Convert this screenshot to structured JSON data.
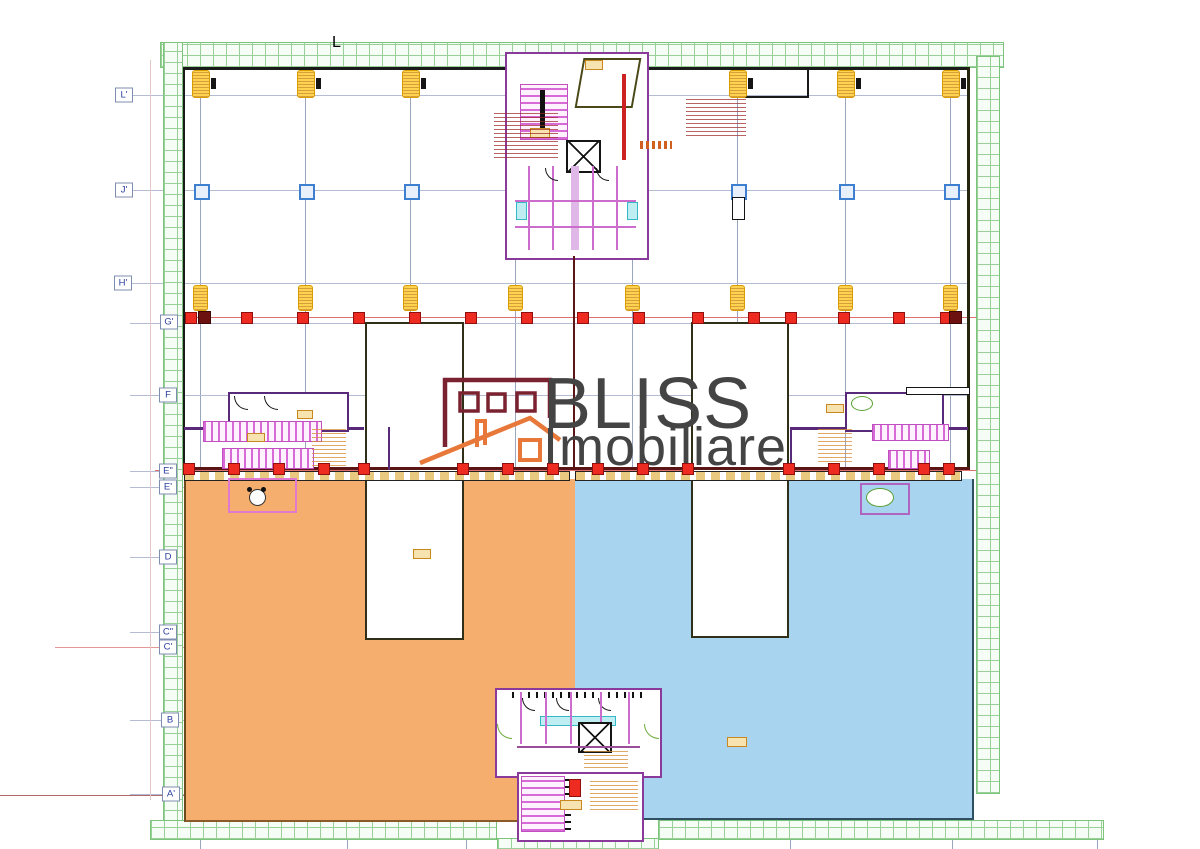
{
  "grid": {
    "top_label": "L",
    "row_labels": [
      {
        "label": "L'",
        "x": 124,
        "y": 95
      },
      {
        "label": "J'",
        "x": 124,
        "y": 190
      },
      {
        "label": "H'",
        "x": 123,
        "y": 283
      },
      {
        "label": "G'",
        "x": 169,
        "y": 322
      },
      {
        "label": "F",
        "x": 168,
        "y": 395
      },
      {
        "label": "E\"",
        "x": 168,
        "y": 471
      },
      {
        "label": "E'",
        "x": 168,
        "y": 487
      },
      {
        "label": "D",
        "x": 168,
        "y": 557
      },
      {
        "label": "C\"",
        "x": 168,
        "y": 632
      },
      {
        "label": "C'",
        "x": 168,
        "y": 647
      },
      {
        "label": "B",
        "x": 170,
        "y": 720
      },
      {
        "label": "A'",
        "x": 171,
        "y": 794
      }
    ],
    "columns_x": [
      200,
      305,
      410,
      515,
      632,
      737,
      845,
      950
    ],
    "full_rows_y": [
      95,
      190,
      283,
      323,
      395
    ],
    "short_rows_y": [
      471,
      487,
      557,
      632,
      647,
      720,
      794
    ]
  },
  "markers": {
    "top_yellow_x": [
      200,
      305,
      410,
      737,
      845,
      950
    ],
    "mid_yellow_x": [
      200,
      305,
      410,
      515,
      632,
      737,
      845,
      950
    ],
    "g_red_x": [
      190,
      246,
      302,
      358,
      414,
      470,
      526,
      582,
      638,
      697,
      753,
      790,
      843,
      898,
      945
    ],
    "g_darkred_x": [
      204,
      955
    ],
    "e_red_x": [
      188,
      233,
      278,
      323,
      363,
      462,
      507,
      552,
      597,
      642,
      687,
      788,
      833,
      878,
      923,
      948
    ],
    "j_blue_x": [
      200,
      305,
      410,
      737,
      845,
      950
    ],
    "bottom_tick_x": [
      200,
      347,
      466,
      627,
      790,
      952,
      1097
    ]
  },
  "zones": [
    {
      "name": "left-terrace",
      "fill": "#f5ae6d"
    },
    {
      "name": "right-terrace",
      "fill": "#a9d4ef"
    }
  ],
  "watermark": {
    "brand_line1": "BLISS",
    "brand_line2": "Imobiliare"
  },
  "colors": {
    "grid_line": "#9aa5c0",
    "row_line": "#b3bcd2",
    "axis_red": "#e07070",
    "wall": "#1a1a1a",
    "terrace_wall": "#5c1515",
    "hatch_green": "#98d098",
    "accent_yellow": "#ffd24f",
    "accent_red": "#ee2b20",
    "marker_blue": "#3f7fd0",
    "wall_purple": "#8a3a9a",
    "stair_magenta": "#d86ad8",
    "logo_maroon": "#7b2230",
    "logo_orange": "#e8773a",
    "watermark_text": "#444444"
  }
}
